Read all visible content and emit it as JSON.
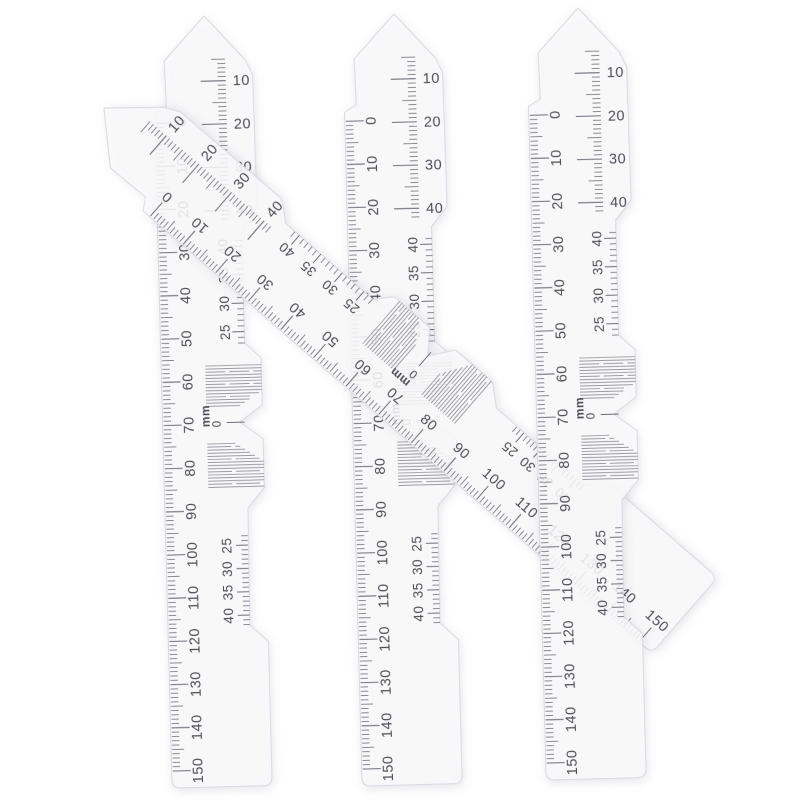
{
  "scene": {
    "background": "#ffffff",
    "object_kind": "translucent optical PD rulers",
    "ruler_count": 4
  },
  "ruler_template": {
    "colors": {
      "body": "rgba(250,250,252,0.86)",
      "edge": "#d9d9e0",
      "ink": "#4d4d55",
      "tick": "#6f6f78",
      "hatch": "#8e8e96"
    },
    "unit_label": "mm",
    "notch_zero_label": "0",
    "head_scale": {
      "major_labels": [
        10,
        20,
        30,
        40
      ],
      "tick_range": [
        5,
        42
      ],
      "px_per_unit": 4.32,
      "origin_y": 22
    },
    "main_scale": {
      "major_labels": [
        0,
        10,
        20,
        30,
        40,
        50,
        60,
        70,
        80,
        90,
        100,
        110,
        120,
        130,
        140,
        150
      ],
      "tick_range": [
        0,
        150
      ],
      "px_per_unit": 4.32,
      "origin_y": 106
    },
    "upper_secondary_scale": {
      "major_labels": [
        40,
        35,
        30,
        25
      ],
      "top_value": 40,
      "tick_range": [
        23,
        41
      ],
      "px_per_unit": 5.7,
      "origin_y": 231
    },
    "lower_secondary_scale": {
      "major_labels": [
        25,
        30,
        35,
        40
      ],
      "top_value": 25,
      "tick_range": [
        23,
        42
      ],
      "px_per_unit": 4.67,
      "origin_y": 530
    }
  },
  "rulers": [
    {
      "id": "pd-ruler-left",
      "apex_x": 204,
      "apex_y": 16,
      "rotation_deg": -1.5,
      "flip_main_labels_from": null
    },
    {
      "id": "pd-ruler-middle",
      "apex_x": 394,
      "apex_y": 14,
      "rotation_deg": -1.5,
      "flip_main_labels_from": null
    },
    {
      "id": "pd-ruler-diagonal",
      "apex_x": 104,
      "apex_y": 108,
      "rotation_deg": -49,
      "flip_main_labels_from": 80
    },
    {
      "id": "pd-ruler-right",
      "apex_x": 578,
      "apex_y": 8,
      "rotation_deg": -1.5,
      "flip_main_labels_from": null
    }
  ]
}
